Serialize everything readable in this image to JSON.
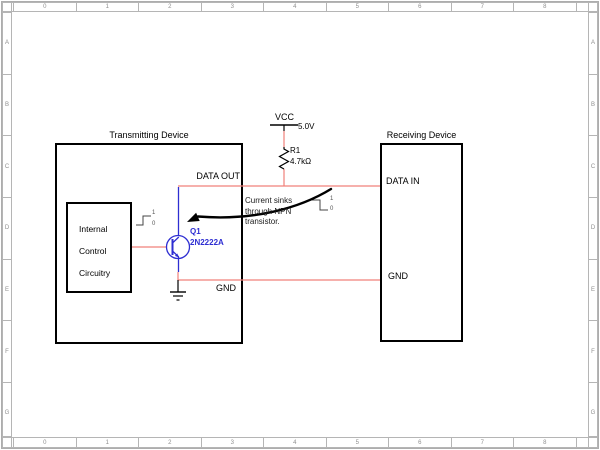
{
  "colors": {
    "wire_red": "#f0807a",
    "symbol_blue": "#2e2ed2",
    "outline": "#000000",
    "ruler_line": "#b5b5b5",
    "ruler_text": "#8f8f8f",
    "annotation_text": "#1a1a1a"
  },
  "rulers": {
    "h_labels": [
      "0",
      "1",
      "2",
      "3",
      "4",
      "5",
      "6",
      "7",
      "8"
    ],
    "v_labels": [
      "A",
      "B",
      "C",
      "D",
      "E",
      "F",
      "G"
    ]
  },
  "transmitting_device": {
    "title": "Transmitting Device",
    "internal_block_lines": [
      "Internal",
      "Control",
      "Circuitry"
    ],
    "data_out_label": "DATA OUT",
    "gnd_label": "GND"
  },
  "receiving_device": {
    "title": "Receiving Device",
    "data_in_label": "DATA IN",
    "gnd_label": "GND"
  },
  "power": {
    "net_label": "VCC",
    "voltage": "5.0V"
  },
  "resistor": {
    "ref": "R1",
    "value": "4.7kΩ"
  },
  "transistor": {
    "ref": "Q1",
    "part": "2N2222A"
  },
  "annotation": {
    "lines": [
      "Current sinks",
      "through NPN",
      "transistor."
    ]
  },
  "logic_levels": {
    "high": "1",
    "low": "0"
  }
}
